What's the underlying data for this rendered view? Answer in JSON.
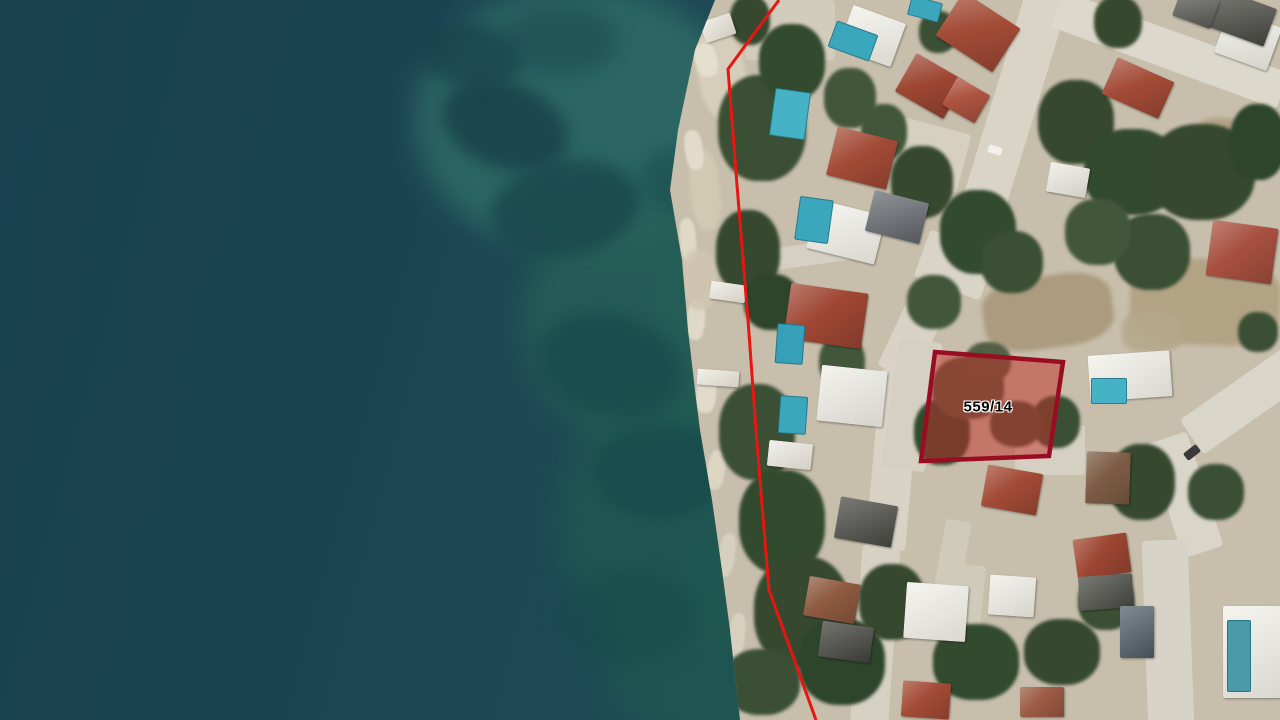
{
  "map": {
    "view_type": "satellite-cadastral",
    "parcel": {
      "label": "559/14",
      "polygon_px": [
        [
          935,
          352
        ],
        [
          1063,
          362
        ],
        [
          1049,
          456
        ],
        [
          921,
          461
        ]
      ],
      "label_pos_px": [
        988,
        407
      ],
      "fill_color": "#c23028",
      "fill_opacity": 0.5,
      "stroke_color": "#990d23",
      "stroke_width": 4.5,
      "label_color": "#000000",
      "label_halo_color": "#ffffff"
    },
    "boundary_line": {
      "color": "#e81511",
      "width": 3,
      "points_px": [
        [
          779,
          0
        ],
        [
          728,
          69
        ],
        [
          737,
          185
        ],
        [
          748,
          320
        ],
        [
          756,
          430
        ],
        [
          762,
          505
        ],
        [
          769,
          590
        ],
        [
          816,
          720
        ]
      ]
    },
    "terrain_colors": {
      "sea_deep": "#1b4251",
      "sea_shallow": "#2f6e68",
      "shore": "#c7beab",
      "road": "#d9d4c6",
      "tree": "#3a4f33",
      "roof_red": "#a34b36",
      "roof_white": "#eceae1",
      "roof_gray": "#54544e",
      "pool": "#3aa7bd",
      "dirt": "#ab9a7c"
    }
  }
}
